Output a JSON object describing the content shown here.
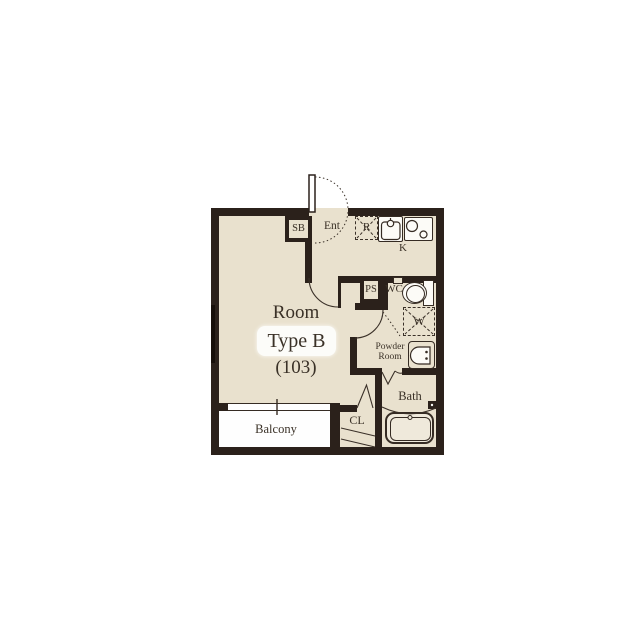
{
  "plan": {
    "unit_label": {
      "room": "Room",
      "type": "Type B",
      "number": "(103)"
    },
    "rooms": {
      "balcony": "Balcony",
      "bath": "Bath",
      "closet": "CL",
      "entrance": "Ent",
      "kitchen": "K",
      "wc": "WC",
      "powder_line1": "Powder",
      "powder_line2": "Room"
    },
    "fixtures": {
      "shoe_box": "SB",
      "pipe_space": "PS",
      "refrigerator": "R",
      "washer": "W"
    },
    "colors": {
      "wall": "#2b211b",
      "floor": "#e9e1ce",
      "background": "#ffffff",
      "line": "#352b23",
      "text": "#3a3127"
    }
  }
}
